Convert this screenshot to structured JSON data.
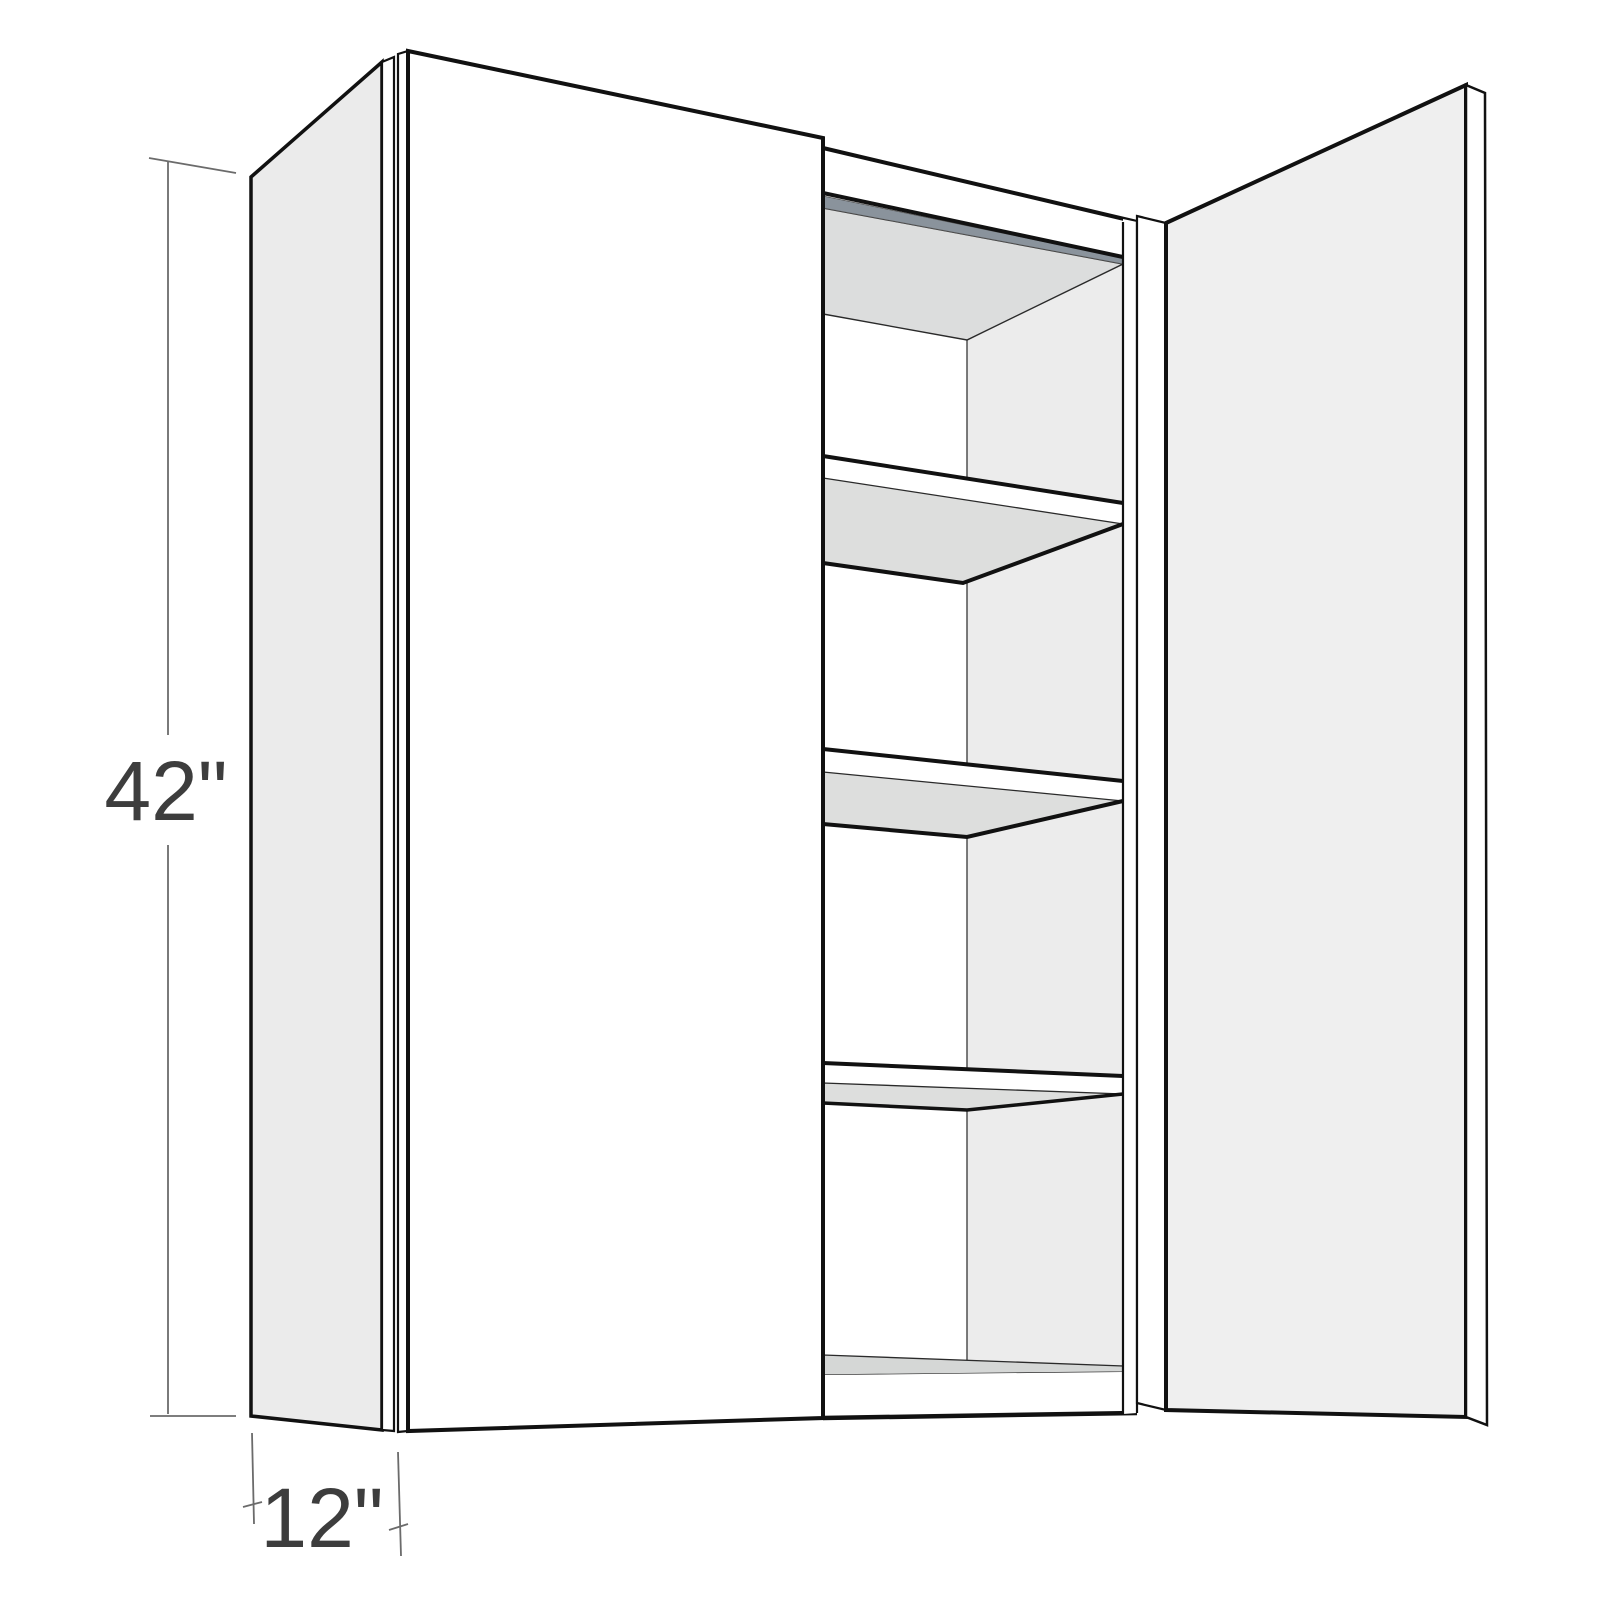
{
  "figure": {
    "type": "wall-cabinet-dimension-diagram",
    "height_label": "42\"",
    "depth_label": "12\""
  },
  "colors": {
    "background": "#ffffff",
    "outline": "#111111",
    "side_panel": "#ebebeb",
    "door_face": "#ffffff",
    "right_door_face": "#efefef",
    "edge_strip": "#ffffff",
    "interior_ceiling": "#dcdddd",
    "interior_side_panel": "#ececec",
    "back_wall": "#ffffff",
    "shelf_underside": "#dddedd",
    "floor_top": "#d5d7d6",
    "hang_rail": "#8a939c",
    "dimension_line": "#6b6b6b",
    "dimension_text": "#3d3d3d"
  }
}
